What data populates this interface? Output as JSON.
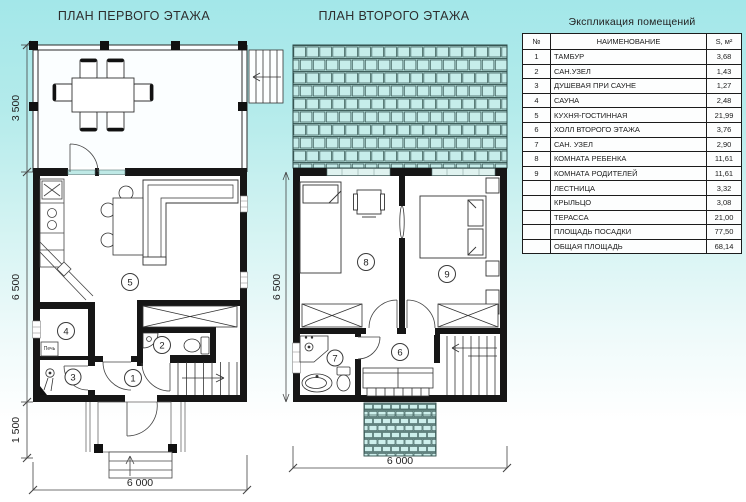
{
  "colors": {
    "background_top": "#a3e7e9",
    "background_bottom": "#ffffff",
    "roof_tile": "#bfeae6",
    "wall": "#161616",
    "line": "#333333"
  },
  "plan1": {
    "title": "ПЛАН ПЕРВОГО ЭТАЖА",
    "dims": {
      "terrace": "3 500",
      "house": "6 500",
      "porch": "1 500",
      "width": "6 000"
    },
    "rooms": {
      "r1": "1",
      "r2": "2",
      "r3": "3",
      "r4": "4",
      "r5": "5"
    },
    "stove": "Печь"
  },
  "plan2": {
    "title": "ПЛАН ВТОРОГО ЭТАЖА",
    "dims": {
      "house": "6 500",
      "width": "6 000"
    },
    "rooms": {
      "r6": "6",
      "r7": "7",
      "r8": "8",
      "r9": "9"
    }
  },
  "legend": {
    "title": "Экспликация помещений",
    "columns": {
      "num": "№",
      "name": "НАИМЕНОВАНИЕ",
      "area": "S, м²"
    },
    "rows": [
      {
        "num": "1",
        "name": "ТАМБУР",
        "area": "3,68"
      },
      {
        "num": "2",
        "name": "САН.УЗЕЛ",
        "area": "1,43"
      },
      {
        "num": "3",
        "name": "ДУШЕВАЯ ПРИ САУНЕ",
        "area": "1,27"
      },
      {
        "num": "4",
        "name": "САУНА",
        "area": "2,48"
      },
      {
        "num": "5",
        "name": "КУХНЯ-ГОСТИННАЯ",
        "area": "21,99"
      },
      {
        "num": "6",
        "name": "ХОЛЛ ВТОРОГО ЭТАЖА",
        "area": "3,76"
      },
      {
        "num": "7",
        "name": "САН. УЗЕЛ",
        "area": "2,90"
      },
      {
        "num": "8",
        "name": "КОМНАТА РЕБЕНКА",
        "area": "11,61"
      },
      {
        "num": "9",
        "name": "КОМНАТА РОДИТЕЛЕЙ",
        "area": "11,61"
      },
      {
        "num": "",
        "name": "ЛЕСТНИЦА",
        "area": "3,32"
      },
      {
        "num": "",
        "name": "КРЫЛЬЦО",
        "area": "3,08"
      },
      {
        "num": "",
        "name": "ТЕРАССА",
        "area": "21,00"
      },
      {
        "num": "",
        "name": "ПЛОЩАДЬ ПОСАДКИ",
        "area": "77,50"
      },
      {
        "num": "",
        "name": "ОБЩАЯ ПЛОЩАДЬ",
        "area": "68,14"
      }
    ]
  }
}
